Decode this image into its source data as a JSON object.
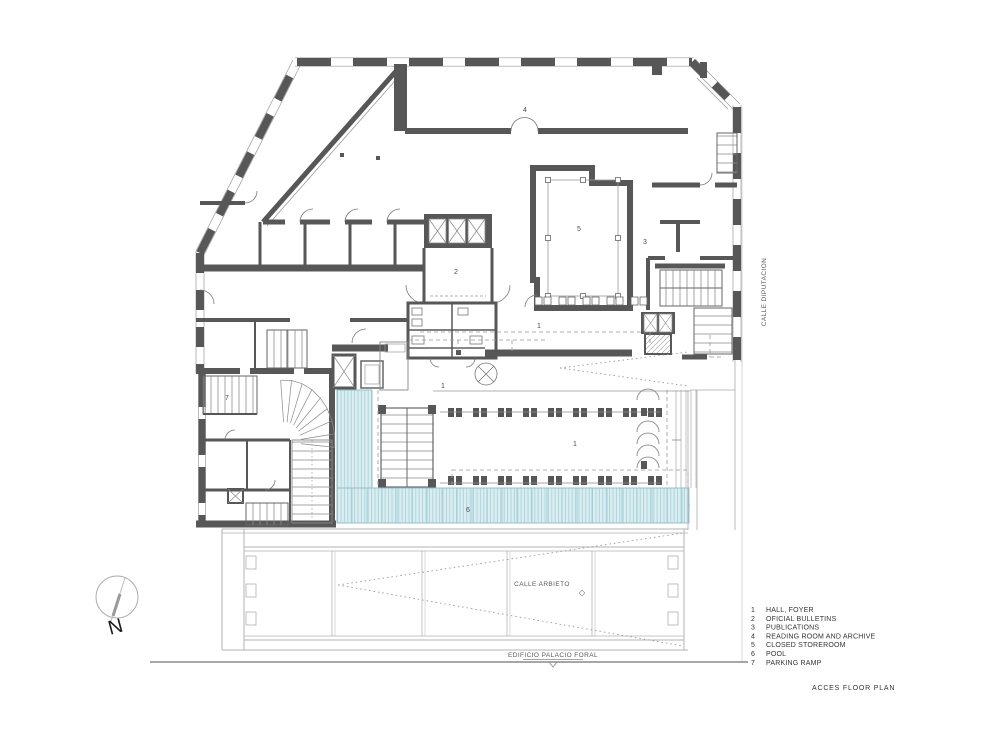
{
  "sheet": {
    "title": "ACCES FLOOR PLAN",
    "building_label": "EDIFICIO PALACIO FORAL",
    "street_bottom": "CALLE ARBIETO",
    "street_right": "CALLE DIPUTACION",
    "north_letter": "N"
  },
  "legend": {
    "items": [
      {
        "num": "1",
        "label": "HALL, FOYER"
      },
      {
        "num": "2",
        "label": "OFICIAL BULLETINS"
      },
      {
        "num": "3",
        "label": "PUBLICATIONS"
      },
      {
        "num": "4",
        "label": "READING ROOM AND ARCHIVE"
      },
      {
        "num": "5",
        "label": "CLOSED STOREROOM"
      },
      {
        "num": "6",
        "label": "POOL"
      },
      {
        "num": "7",
        "label": "PARKING RAMP"
      }
    ]
  },
  "room_labels": [
    {
      "text": "4",
      "x": 525,
      "y": 112
    },
    {
      "text": "5",
      "x": 579,
      "y": 231
    },
    {
      "text": "3",
      "x": 645,
      "y": 244
    },
    {
      "text": "2",
      "x": 456,
      "y": 274
    },
    {
      "text": "1",
      "x": 539,
      "y": 328
    },
    {
      "text": "1",
      "x": 443,
      "y": 388
    },
    {
      "text": "1",
      "x": 575,
      "y": 446
    },
    {
      "text": "6",
      "x": 468,
      "y": 512
    },
    {
      "text": "7",
      "x": 227,
      "y": 400
    }
  ],
  "colors": {
    "wall": "#575757",
    "thin_line": "#999999",
    "street_line": "#b3b3b3",
    "pool_fill": "#daeef2",
    "pool_hatch": "#a5ced6",
    "pool_grid": "#8fc3cc",
    "pool_label": "#8a4a42",
    "text_dark": "#333333"
  }
}
